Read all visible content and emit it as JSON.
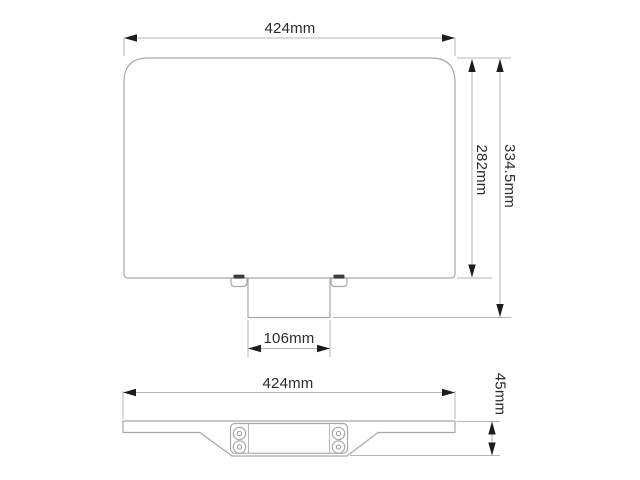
{
  "drawing": {
    "description": "Two-view dimensioned technical drawing of a mount shelf",
    "front_view": {
      "width_label": "424mm",
      "panel_height_label": "282mm",
      "total_height_label": "334.5mm",
      "bracket_width_label": "106mm"
    },
    "bottom_view": {
      "width_label": "424mm",
      "depth_label": "45mm"
    },
    "colors": {
      "background": "#ffffff",
      "outline": "#a8a8a8",
      "dimension_line": "#b6b6b6",
      "arrowhead": "#1c1c1c",
      "text": "#2b2b2b",
      "clip_slot": "#3c3c3c"
    }
  }
}
